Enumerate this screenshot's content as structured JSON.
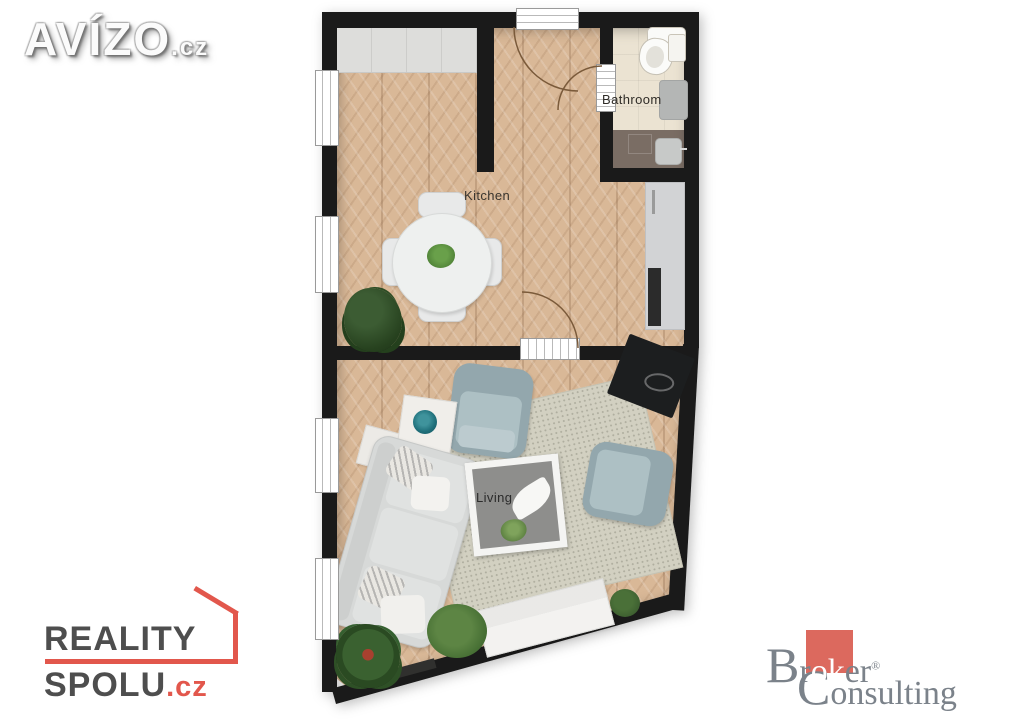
{
  "watermarks": {
    "avizo": {
      "name": "AVÍZO",
      "tld": ".cz"
    },
    "reality_spolu": {
      "line1": "REALITY",
      "line2": "SPOLU",
      "tld": ".cz",
      "accent_color": "#e2574c",
      "text_color": "#4e4e4e"
    },
    "broker_consulting": {
      "b": "B",
      "r": "r",
      "highlight": "ok",
      "tail": "er",
      "reg": "®",
      "c": "C",
      "line2_tail": "onsulting",
      "text_color": "#7b828a",
      "box_color": "#dc695e"
    }
  },
  "floorplan": {
    "rooms": [
      {
        "id": "kitchen",
        "label": "Kitchen"
      },
      {
        "id": "bathroom",
        "label": "Bathroom"
      },
      {
        "id": "living",
        "label": "Living"
      }
    ],
    "colors": {
      "wall": "#1a1a1a",
      "wood_floor": "#d9b897",
      "bath_floor": "#ebe3d2",
      "bath_dark_floor": "#7a6d64",
      "rug": "#d2d0c1",
      "counter": "#d2d3d5",
      "sofa": "#d7d9d8",
      "armchair": "#93a7ad",
      "accent_bowl": "#1f6f7a"
    }
  }
}
